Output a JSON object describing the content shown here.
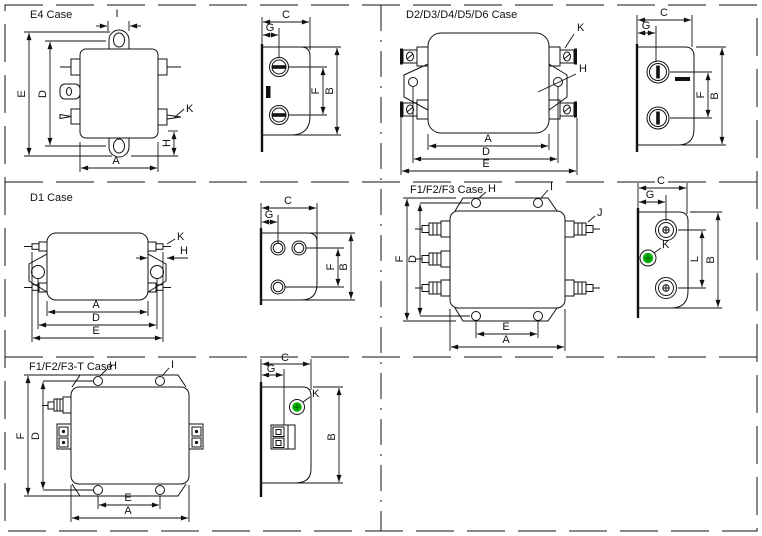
{
  "document": {
    "type": "emi-filter-case-outline-drawings",
    "background": "#ffffff"
  },
  "colors": {
    "line": "#111111",
    "ground_terminal_green": "#00b400",
    "ground_terminal_green_dark": "#007700"
  },
  "dims": {
    "A": "A",
    "B": "B",
    "C": "C",
    "D": "D",
    "E": "E",
    "F": "F",
    "G": "G",
    "H": "H",
    "I": "I",
    "J": "J",
    "K": "K",
    "L": "L"
  },
  "cases": {
    "e4": {
      "title": "E4 Case"
    },
    "d2_d6": {
      "title": "D2/D3/D4/D5/D6 Case"
    },
    "d1": {
      "title": "D1 Case"
    },
    "f1_f3": {
      "title": "F1/F2/F3 Case"
    },
    "f1_f3_t": {
      "title": "F1/F2/F3-T Case"
    }
  }
}
